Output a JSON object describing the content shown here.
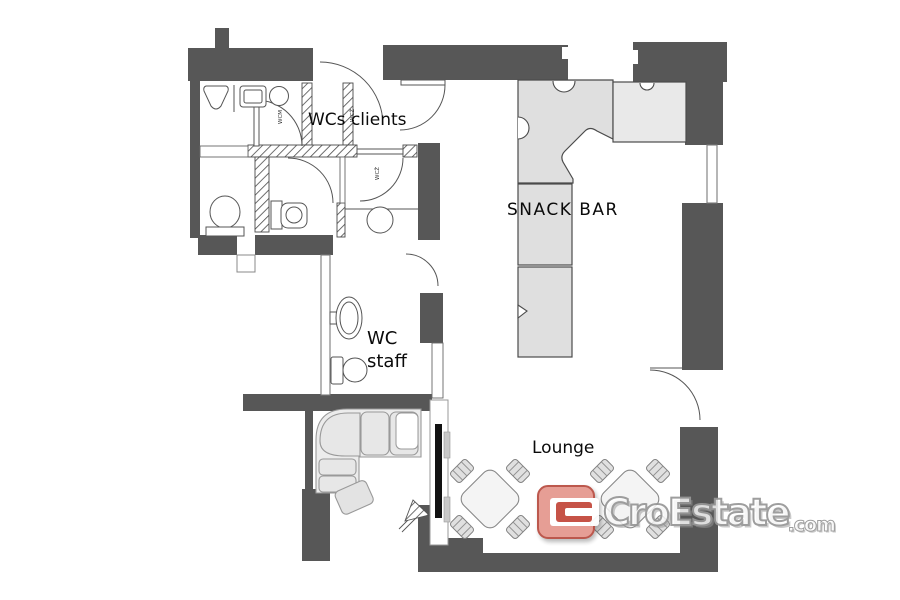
{
  "plan": {
    "labels": {
      "wcs_clients": "WCs clients",
      "snack_bar": "SNACK BAR",
      "wc_staff_line1": "WC",
      "wc_staff_line2": "staff",
      "lounge": "Lounge",
      "room_code_1": "WCM",
      "room_code_2": "WCŽ",
      "room_code_3": "WCŽ"
    },
    "colors": {
      "wall": "#575757",
      "counter": "#dfdfdf",
      "counter_light": "#e9e9e9",
      "furniture": "#ececec",
      "table": "#f4f4f4",
      "outline": "#4b4b4b"
    }
  },
  "watermark": {
    "brand": "CroEstate",
    "tld": ".com",
    "colors": {
      "mark_outer": "#e5978e",
      "mark_inner": "#c2473a",
      "mark_border": "#b84c40",
      "text_outline": "#979797"
    }
  }
}
